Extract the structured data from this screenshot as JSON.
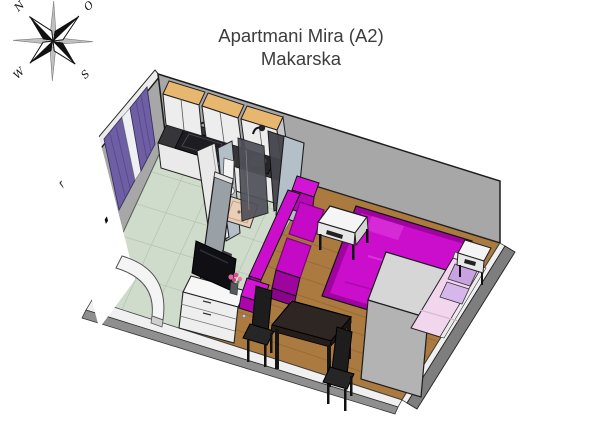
{
  "title": {
    "line1": "Apartmani Mira (A2)",
    "line2": "Makarska"
  },
  "compass": {
    "n": "N",
    "e": "O",
    "s": "S",
    "w": "W"
  },
  "palette": {
    "wall_gray": "#a7a7a7",
    "wood_floor": "#aa7a40",
    "tile_floor": "#cfdccb",
    "bathroom_wall": "#b4c0c8",
    "curtain_purple": "#6e5fa4",
    "door_glass_blue": "#7f9fd9",
    "magenta_bright": "#cb0ecb",
    "magenta_dark": "#a004a0",
    "single_bed_pink": "#f2d6ee",
    "pillow_lilac": "#c9a2e2",
    "cabinet_top_tan": "#e8b76f",
    "counter_dark": "#36363a",
    "table_darkwood": "#2e2622",
    "wardrobe_gray": "#b3b3b3",
    "shower_glass": "#515159",
    "shower_tray_tan": "#e9cfb7",
    "flower_pink": "#e0679f"
  },
  "furniture_items": [
    "kitchen upper cabinets",
    "kitchen counter with sink and cooktop",
    "entrance door with blue glass",
    "windows with purple curtains",
    "bathroom with shower and toilet",
    "magenta sofa",
    "white side table",
    "magenta double bed",
    "gray wardrobe",
    "pink single bed with lilac pillows",
    "white nightstand",
    "dark dining table with two chairs",
    "white dresser with TV and flower vase",
    "door swing arc"
  ]
}
